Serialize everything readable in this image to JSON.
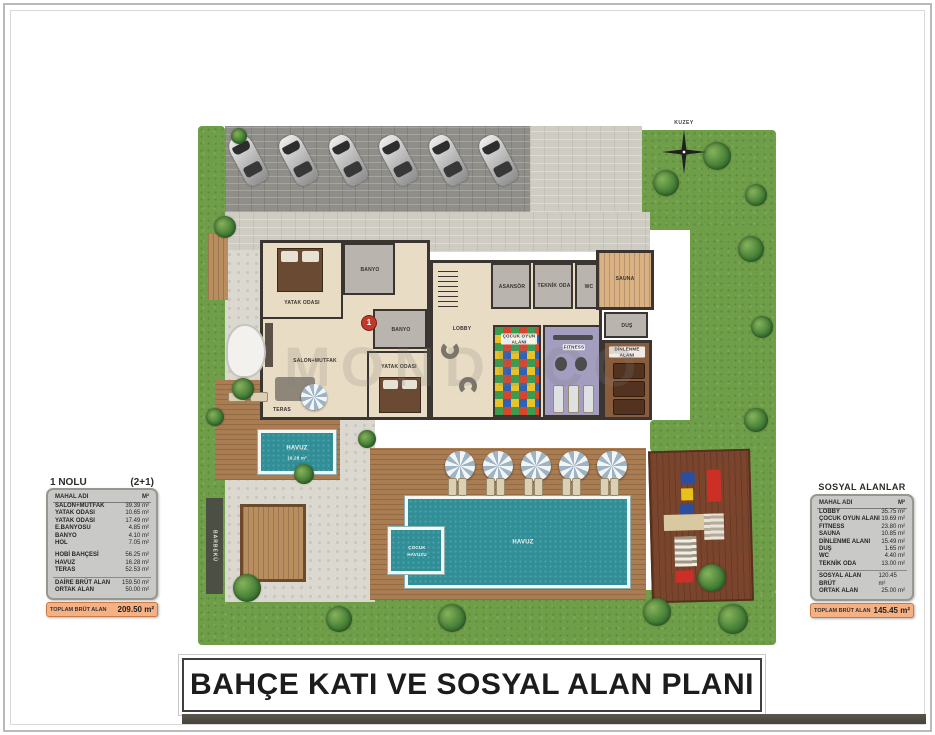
{
  "page": {
    "title": "BAHÇE KATI VE SOSYAL ALAN PLANI",
    "watermark": "MONDECO"
  },
  "compass": {
    "label": "KUZEY"
  },
  "unit_table": {
    "title": "1  NOLU",
    "type": "(2+1)",
    "header": {
      "name": "MAHAL ADI",
      "area": "M²"
    },
    "rows": [
      {
        "name": "SALON+MUTFAK",
        "area": "39.39 m²"
      },
      {
        "name": "YATAK ODASI",
        "area": "10.65 m²"
      },
      {
        "name": "YATAK ODASI",
        "area": "17.49 m²"
      },
      {
        "name": "E.BANYOSU",
        "area": "4.85 m²"
      },
      {
        "name": "BANYO",
        "area": "4.10 m²"
      },
      {
        "name": "HOL",
        "area": "7.05 m²"
      }
    ],
    "rows2": [
      {
        "name": "HOBİ BAHÇESİ",
        "area": "56.25 m²"
      },
      {
        "name": "HAVUZ",
        "area": "16.28 m²"
      },
      {
        "name": "TERAS",
        "area": "52.53 m²"
      }
    ],
    "summary": [
      {
        "name": "DAİRE BRÜT ALAN",
        "area": "159.50 m²"
      },
      {
        "name": "ORTAK ALAN",
        "area": "50.00 m²"
      }
    ],
    "total": {
      "name": "TOPLAM BRÜT ALAN",
      "area": "209.50 m²"
    }
  },
  "social_table": {
    "title": "SOSYAL ALANLAR",
    "header": {
      "name": "MAHAL ADI",
      "area": "M²"
    },
    "rows": [
      {
        "name": "LOBBY",
        "area": "35.75 m²"
      },
      {
        "name": "ÇOCUK OYUN ALANI",
        "area": "19.69 m²"
      },
      {
        "name": "FITNESS",
        "area": "23.80 m²"
      },
      {
        "name": "SAUNA",
        "area": "10.85 m²"
      },
      {
        "name": "DİNLENME ALANI",
        "area": "15.49 m²"
      },
      {
        "name": "DUŞ",
        "area": "1.65 m²"
      },
      {
        "name": "WC",
        "area": "4.40 m²"
      },
      {
        "name": "TEKNİK ODA",
        "area": "13.00 m²"
      }
    ],
    "summary": [
      {
        "name": "SOSYAL ALAN BRÜT",
        "area": "120.45 m²"
      },
      {
        "name": "ORTAK ALAN",
        "area": "25.00 m²"
      }
    ],
    "total": {
      "name": "TOPLAM BRÜT ALAN",
      "area": "145.45 m²"
    }
  },
  "plan": {
    "labels": {
      "yatak_odasi_1": "YATAK ODASI",
      "banyo_1": "BANYO",
      "yatak_odasi_2": "YATAK ODASI",
      "banyo_2": "BANYO",
      "salon_mutfak": "SALON+MUTFAK",
      "teras": "TERAS",
      "havuz": "HAVUZ",
      "havuz_area": "16.28 m²",
      "unit_no": "1",
      "asansor": "ASANSÖR",
      "teknik_oda": "TEKNİK ODA",
      "wc": "WC",
      "sauna": "SAUNA",
      "dus": "DUŞ",
      "dinlenme": "DİNLENME ALANI",
      "cocuk_oyun": "ÇOCUK OYUN ALANI",
      "fitness": "FITNESS",
      "lobby": "LOBBY",
      "havuz_main": "HAVUZ",
      "cocuk_havuzu": "ÇOCUK HAVUZU",
      "barbeku": "BARBEKÜ"
    }
  },
  "colors": {
    "accent_orange": "#f5b183",
    "pool_teal": "#2f8e96",
    "grass_green": "#6f9e49",
    "deck_brown": "#a97c52",
    "wall_dark": "#3a3530",
    "fitness_purple": "#a39ec0",
    "sauna_wood": "#d9b183",
    "unit_badge_red": "#c0392b"
  }
}
